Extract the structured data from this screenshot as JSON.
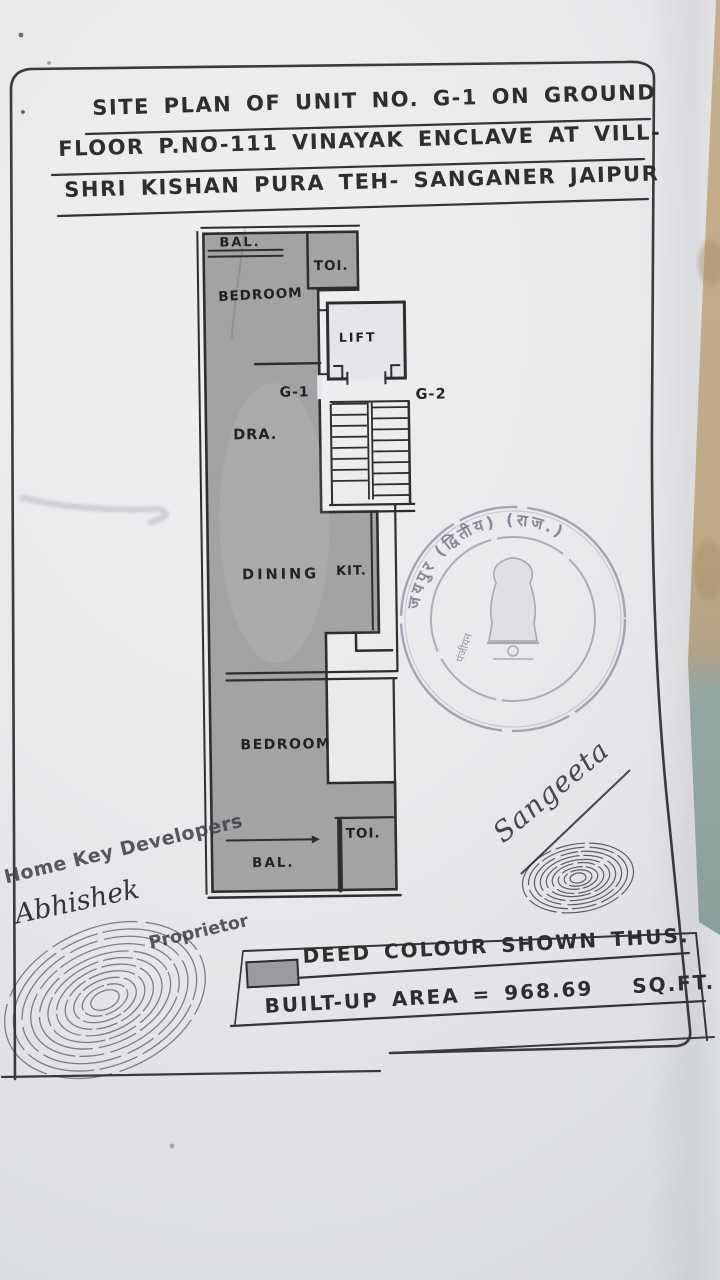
{
  "document": {
    "title_lines": [
      "SITE PLAN OF UNIT NO. G-1 ON GROUND",
      "FLOOR P.NO-111 VINAYAK ENCLAVE AT VILL-",
      "SHRI KISHAN PURA TEH- SANGANER JAIPUR"
    ]
  },
  "floor_plan": {
    "rooms": {
      "balcony_top": "BAL.",
      "toilet_top": "TOI.",
      "bedroom_top": "BEDROOM",
      "lift": "LIFT",
      "drawing_room": "DRA.",
      "dining": "DINING",
      "kitchen": "KIT.",
      "bedroom_bottom": "BEDROOM",
      "toilet_bottom": "TOI.",
      "balcony_bottom": "BAL."
    },
    "unit_labels": {
      "this_unit": "G-1",
      "adjacent_unit": "G-2"
    }
  },
  "legend": {
    "deed_colour_text": "DEED COLOUR SHOWN THUS.",
    "built_up_area_text": "BUILT-UP AREA = 968.69",
    "area_unit": "SQ.FT."
  },
  "stamp": {
    "arc_text": "जयपुर (द्वितीय) (राज.)",
    "left_text": "पंजीयन"
  },
  "signatures": {
    "signature_right": "Sangeeta",
    "developer_stamp": "Home Key Developers",
    "developer_sign": "Abhishek",
    "designation": "Proprietor"
  },
  "colors": {
    "paper": "#e7e9ec",
    "deed_shade": "#a3a2a4",
    "ink": "#2f2d2e",
    "stamp_ink": "#6f6580",
    "backdrop": "#c4ad8b"
  }
}
